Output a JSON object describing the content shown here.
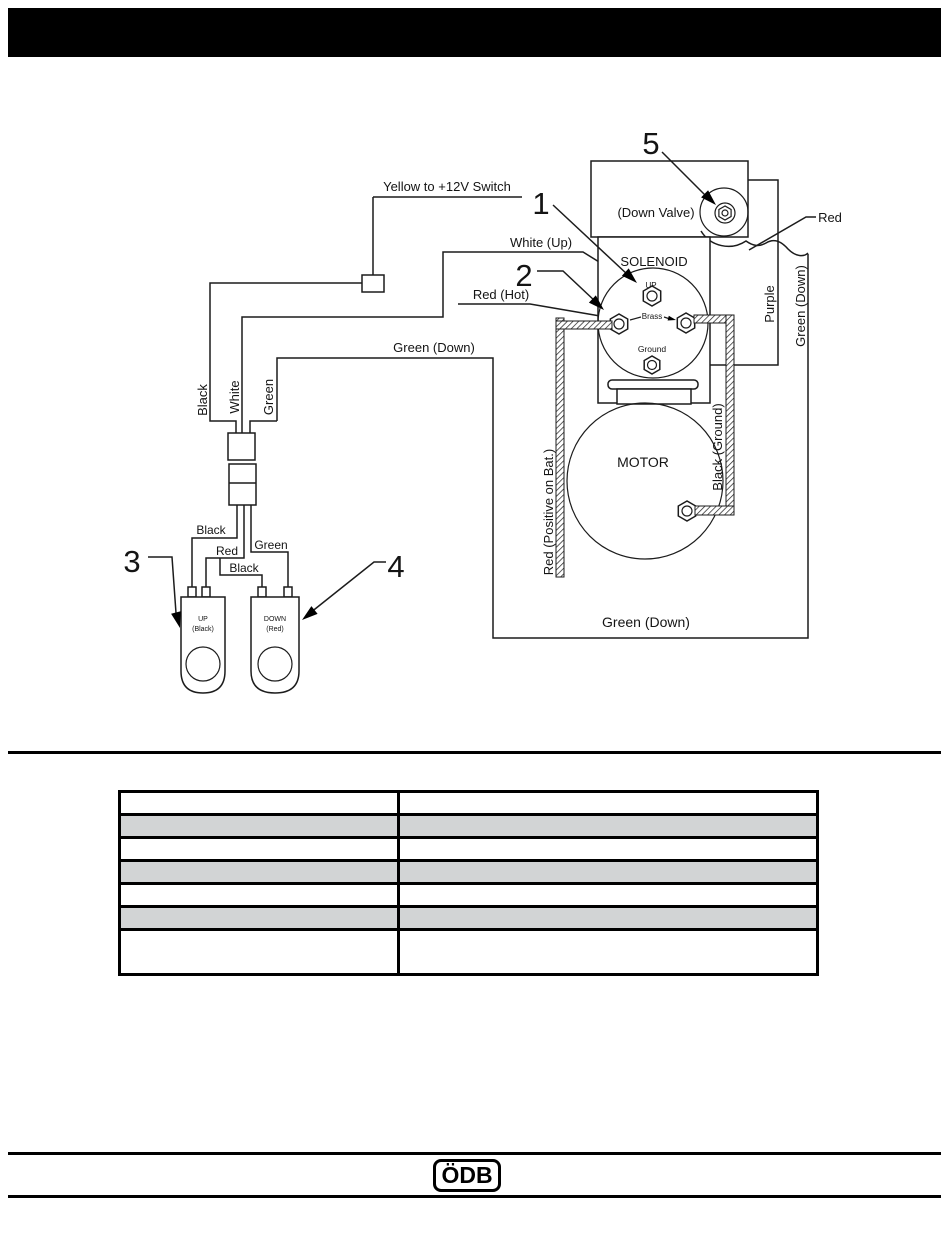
{
  "header": {
    "bar_color": "#000000"
  },
  "diagram": {
    "yellow_switch_label": "Yellow to +12V Switch",
    "white_up_label": "White (Up)",
    "red_hot_label": "Red (Hot)",
    "green_down_label": "Green (Down)",
    "green_down_bottom_label": "Green (Down)",
    "green_down_vertical_label": "Green (Down)",
    "purple_label": "Purple",
    "red_label": "Red",
    "black_vertical_label": "Black",
    "white_vertical_label": "White",
    "green_vertical_label": "Green",
    "red_positive_label": "Red (Positive on Bat.)",
    "black_ground_label": "Black (Ground)",
    "wire_black_label": "Black",
    "wire_red_label": "Red",
    "wire_green_label": "Green",
    "wire_black_jumper_label": "Black",
    "down_valve_label": "(Down Valve)",
    "solenoid_label": "SOLENOID",
    "motor_label": "MOTOR",
    "up_terminal_label": "UP",
    "brass_terminal_label": "Brass",
    "ground_terminal_label": "Ground",
    "up_button_label": "UP",
    "up_button_sublabel": "(Black)",
    "down_button_label": "DOWN",
    "down_button_sublabel": "(Red)",
    "callouts": [
      "1",
      "2",
      "3",
      "4",
      "5"
    ]
  },
  "table": {
    "zebra_color": "#d2d4d5",
    "rows": [
      {
        "c1": "",
        "c2": ""
      },
      {
        "c1": "",
        "c2": ""
      },
      {
        "c1": "",
        "c2": ""
      },
      {
        "c1": "",
        "c2": ""
      },
      {
        "c1": "",
        "c2": ""
      },
      {
        "c1": "",
        "c2": ""
      },
      {
        "c1": "",
        "c2": ""
      }
    ]
  },
  "footer": {
    "logo_text": "ÖDB"
  }
}
